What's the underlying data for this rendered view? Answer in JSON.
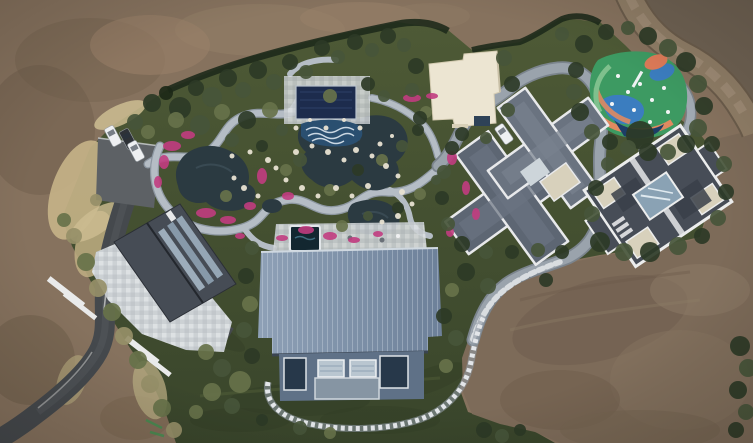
{
  "meta": {
    "title": "Aerial drone photograph",
    "width": 753,
    "height": 443
  },
  "scene": {
    "type": "aerial-drone-photograph",
    "description": "Top-down aerial drone view of a landscaped private estate: a water garden with dark ponds, white rock edges and pink azalea beds, a navy pergola and wave pool, a white flat-roof pavilion, a colorful playground, two gray-roof villas, a large blue metal-roof hall, a west house with stone patio, a parking area with cars, winding light paths and an asphalt driveway, all surrounded by bare graded brown earth and a dirt road.",
    "palette": {
      "dirt_base": "#86725e",
      "dirt_light": "#9a8269",
      "dirt_dark": "#6f6253",
      "dirt_rose": "#7d6b59",
      "dry_grass": "#c6b488",
      "lawn_top": "#4e5a36",
      "lawn_bottom": "#39452b",
      "hedge": "#1e2a1b",
      "path": "#b5bdc5",
      "path_dark": "#7b848d",
      "road_gray": "#9aa3ac",
      "asphalt": "#45494d",
      "pond": "#2b3a41",
      "flower_pink": "#c13c80",
      "barn_roof_a": "#8ea0b6",
      "barn_roof_b": "#6d8099",
      "barn_wing": "#5f7187",
      "villa_roof": "#6a7380",
      "villa_roof_dark": "#5d6673",
      "villa_b_roof": "#474d57",
      "villa_trim": "#e8e9eb",
      "beige_flat": "#d8d1bc",
      "white_building": "#ece5d2",
      "pergola_navy": "#1d2c4d",
      "wave_pool": "#2a4f70",
      "play_green": "#3d9a62",
      "play_blue": "#3b7dbf",
      "play_orange": "#e08a60",
      "play_navy": "#1d3d66",
      "pool_dark": "#132730",
      "stone_light": "#e8e2d2",
      "patio_stone": "#ccd1d4",
      "car_white": "#eef0f2",
      "car_dark": "#2e3237"
    },
    "tree_shades": {
      "h": "#1c2817",
      "d": "#2c3a26",
      "m": "#46553a",
      "o": "#67724a",
      "p": "#968f68"
    },
    "trees": [
      [
        152,
        103,
        9,
        "d"
      ],
      [
        166,
        93,
        7,
        "h"
      ],
      [
        180,
        108,
        11,
        "d"
      ],
      [
        196,
        88,
        8,
        "d"
      ],
      [
        212,
        97,
        10,
        "m"
      ],
      [
        228,
        78,
        9,
        "d"
      ],
      [
        243,
        90,
        8,
        "m"
      ],
      [
        258,
        70,
        9,
        "d"
      ],
      [
        274,
        82,
        8,
        "m"
      ],
      [
        290,
        62,
        8,
        "d"
      ],
      [
        306,
        72,
        7,
        "m"
      ],
      [
        322,
        48,
        8,
        "d"
      ],
      [
        338,
        57,
        7,
        "m"
      ],
      [
        355,
        42,
        8,
        "d"
      ],
      [
        372,
        50,
        7,
        "m"
      ],
      [
        388,
        36,
        8,
        "d"
      ],
      [
        404,
        45,
        7,
        "m"
      ],
      [
        135,
        122,
        8,
        "m"
      ],
      [
        148,
        132,
        7,
        "o"
      ],
      [
        176,
        120,
        8,
        "o"
      ],
      [
        200,
        125,
        10,
        "m"
      ],
      [
        222,
        112,
        8,
        "o"
      ],
      [
        247,
        120,
        9,
        "d"
      ],
      [
        270,
        110,
        8,
        "o"
      ],
      [
        232,
        140,
        7,
        "m"
      ],
      [
        282,
        130,
        6,
        "m"
      ],
      [
        262,
        146,
        6,
        "d"
      ],
      [
        300,
        160,
        7,
        "m"
      ],
      [
        330,
        96,
        7,
        "o"
      ],
      [
        368,
        84,
        7,
        "d"
      ],
      [
        384,
        96,
        6,
        "m"
      ],
      [
        286,
        170,
        6,
        "o"
      ],
      [
        226,
        196,
        6,
        "o"
      ],
      [
        330,
        190,
        6,
        "o"
      ],
      [
        358,
        170,
        6,
        "d"
      ],
      [
        382,
        160,
        6,
        "o"
      ],
      [
        402,
        146,
        6,
        "m"
      ],
      [
        418,
        130,
        6,
        "d"
      ],
      [
        426,
        112,
        6,
        "o"
      ],
      [
        342,
        226,
        6,
        "o"
      ],
      [
        368,
        216,
        5,
        "m"
      ],
      [
        398,
        208,
        6,
        "d"
      ],
      [
        420,
        194,
        6,
        "o"
      ],
      [
        436,
        180,
        5,
        "m"
      ],
      [
        416,
        66,
        8,
        "d"
      ],
      [
        412,
        90,
        7,
        "m"
      ],
      [
        420,
        118,
        7,
        "d"
      ],
      [
        504,
        58,
        8,
        "m"
      ],
      [
        512,
        84,
        8,
        "d"
      ],
      [
        508,
        110,
        7,
        "m"
      ],
      [
        462,
        134,
        7,
        "d"
      ],
      [
        486,
        138,
        6,
        "m"
      ],
      [
        584,
        44,
        9,
        "d"
      ],
      [
        562,
        34,
        7,
        "m"
      ],
      [
        606,
        32,
        8,
        "d"
      ],
      [
        628,
        28,
        7,
        "m"
      ],
      [
        648,
        36,
        9,
        "d"
      ],
      [
        668,
        48,
        9,
        "m"
      ],
      [
        686,
        62,
        10,
        "d"
      ],
      [
        698,
        84,
        9,
        "m"
      ],
      [
        704,
        106,
        9,
        "d"
      ],
      [
        698,
        128,
        9,
        "m"
      ],
      [
        686,
        144,
        9,
        "d"
      ],
      [
        668,
        152,
        8,
        "m"
      ],
      [
        648,
        152,
        9,
        "d"
      ],
      [
        640,
        135,
        14,
        "d"
      ],
      [
        628,
        148,
        8,
        "m"
      ],
      [
        610,
        142,
        8,
        "d"
      ],
      [
        592,
        132,
        8,
        "m"
      ],
      [
        580,
        112,
        9,
        "d"
      ],
      [
        574,
        92,
        8,
        "m"
      ],
      [
        576,
        70,
        8,
        "d"
      ],
      [
        608,
        164,
        7,
        "m"
      ],
      [
        596,
        188,
        8,
        "d"
      ],
      [
        592,
        214,
        8,
        "m"
      ],
      [
        600,
        242,
        10,
        "d"
      ],
      [
        624,
        252,
        9,
        "m"
      ],
      [
        650,
        252,
        10,
        "d"
      ],
      [
        678,
        246,
        9,
        "m"
      ],
      [
        702,
        236,
        8,
        "d"
      ],
      [
        718,
        218,
        8,
        "m"
      ],
      [
        726,
        192,
        8,
        "d"
      ],
      [
        724,
        164,
        8,
        "m"
      ],
      [
        712,
        144,
        8,
        "d"
      ],
      [
        452,
        148,
        7,
        "d"
      ],
      [
        444,
        172,
        7,
        "m"
      ],
      [
        442,
        198,
        7,
        "d"
      ],
      [
        448,
        224,
        7,
        "m"
      ],
      [
        462,
        244,
        8,
        "d"
      ],
      [
        486,
        252,
        7,
        "m"
      ],
      [
        512,
        252,
        7,
        "d"
      ],
      [
        538,
        250,
        7,
        "m"
      ],
      [
        562,
        252,
        7,
        "d"
      ],
      [
        466,
        272,
        9,
        "d"
      ],
      [
        488,
        286,
        8,
        "m"
      ],
      [
        452,
        290,
        7,
        "o"
      ],
      [
        444,
        316,
        8,
        "d"
      ],
      [
        456,
        338,
        8,
        "m"
      ],
      [
        446,
        366,
        7,
        "o"
      ],
      [
        546,
        280,
        7,
        "d"
      ],
      [
        252,
        248,
        7,
        "m"
      ],
      [
        246,
        276,
        8,
        "d"
      ],
      [
        250,
        304,
        8,
        "o"
      ],
      [
        244,
        330,
        8,
        "m"
      ],
      [
        252,
        356,
        8,
        "d"
      ],
      [
        240,
        382,
        11,
        "o"
      ],
      [
        222,
        368,
        9,
        "m"
      ],
      [
        206,
        352,
        8,
        "o"
      ],
      [
        212,
        392,
        9,
        "o"
      ],
      [
        232,
        406,
        8,
        "m"
      ],
      [
        196,
        412,
        7,
        "o"
      ],
      [
        300,
        428,
        7,
        "m"
      ],
      [
        330,
        433,
        6,
        "o"
      ],
      [
        262,
        420,
        6,
        "d"
      ],
      [
        484,
        430,
        8,
        "d"
      ],
      [
        502,
        436,
        7,
        "m"
      ],
      [
        520,
        430,
        6,
        "d"
      ],
      [
        740,
        346,
        10,
        "d"
      ],
      [
        748,
        368,
        9,
        "m"
      ],
      [
        738,
        390,
        9,
        "d"
      ],
      [
        746,
        412,
        8,
        "m"
      ],
      [
        736,
        430,
        8,
        "d"
      ],
      [
        74,
        236,
        8,
        "p"
      ],
      [
        86,
        262,
        9,
        "o"
      ],
      [
        98,
        288,
        9,
        "p"
      ],
      [
        112,
        312,
        9,
        "o"
      ],
      [
        124,
        336,
        9,
        "p"
      ],
      [
        138,
        360,
        9,
        "o"
      ],
      [
        150,
        384,
        9,
        "p"
      ],
      [
        162,
        408,
        9,
        "o"
      ],
      [
        174,
        430,
        8,
        "p"
      ],
      [
        64,
        220,
        7,
        "o"
      ],
      [
        96,
        200,
        6,
        "p"
      ]
    ],
    "flowers": [
      [
        172,
        146,
        9,
        5
      ],
      [
        188,
        135,
        7,
        4
      ],
      [
        164,
        162,
        5,
        7
      ],
      [
        206,
        213,
        10,
        5
      ],
      [
        228,
        220,
        8,
        4
      ],
      [
        250,
        206,
        6,
        4
      ],
      [
        262,
        176,
        5,
        8
      ],
      [
        288,
        196,
        6,
        4
      ],
      [
        306,
        230,
        8,
        4
      ],
      [
        330,
        236,
        7,
        4
      ],
      [
        282,
        238,
        6,
        3
      ],
      [
        412,
        98,
        9,
        4
      ],
      [
        432,
        96,
        6,
        3
      ],
      [
        452,
        158,
        5,
        7
      ],
      [
        466,
        188,
        4,
        7
      ],
      [
        476,
        214,
        4,
        6
      ],
      [
        354,
        240,
        6,
        3
      ],
      [
        378,
        234,
        5,
        3
      ],
      [
        158,
        182,
        4,
        6
      ],
      [
        450,
        232,
        4,
        5
      ],
      [
        240,
        236,
        5,
        3
      ]
    ],
    "stones": [
      [
        268,
        160,
        3
      ],
      [
        276,
        168,
        2.5
      ],
      [
        296,
        152,
        3
      ],
      [
        312,
        146,
        2.5
      ],
      [
        328,
        152,
        3
      ],
      [
        344,
        160,
        2.5
      ],
      [
        356,
        150,
        3
      ],
      [
        372,
        156,
        2.5
      ],
      [
        386,
        166,
        3
      ],
      [
        398,
        176,
        2.5
      ],
      [
        368,
        186,
        3
      ],
      [
        352,
        196,
        2.5
      ],
      [
        336,
        188,
        3
      ],
      [
        318,
        196,
        2.5
      ],
      [
        302,
        188,
        3
      ],
      [
        286,
        180,
        2.5
      ],
      [
        402,
        192,
        3
      ],
      [
        412,
        204,
        2.5
      ],
      [
        398,
        216,
        3
      ],
      [
        382,
        222,
        2.5
      ],
      [
        258,
        196,
        2.5
      ],
      [
        244,
        188,
        3
      ],
      [
        234,
        178,
        2.5
      ],
      [
        250,
        152,
        2.5
      ],
      [
        360,
        128,
        2.5
      ],
      [
        344,
        120,
        2
      ],
      [
        326,
        128,
        2.5
      ],
      [
        310,
        120,
        2
      ],
      [
        296,
        128,
        2.5
      ],
      [
        232,
        156,
        2.5
      ],
      [
        380,
        144,
        2.5
      ],
      [
        392,
        136,
        2
      ]
    ],
    "cars": [
      {
        "x": 113,
        "y": 136,
        "rot": -28,
        "shade": "light"
      },
      {
        "x": 128,
        "y": 139,
        "rot": -28,
        "shade": "dark"
      },
      {
        "x": 136,
        "y": 151,
        "rot": -28,
        "shade": "light"
      },
      {
        "x": 504,
        "y": 134,
        "rot": -35,
        "shade": "light"
      }
    ]
  }
}
